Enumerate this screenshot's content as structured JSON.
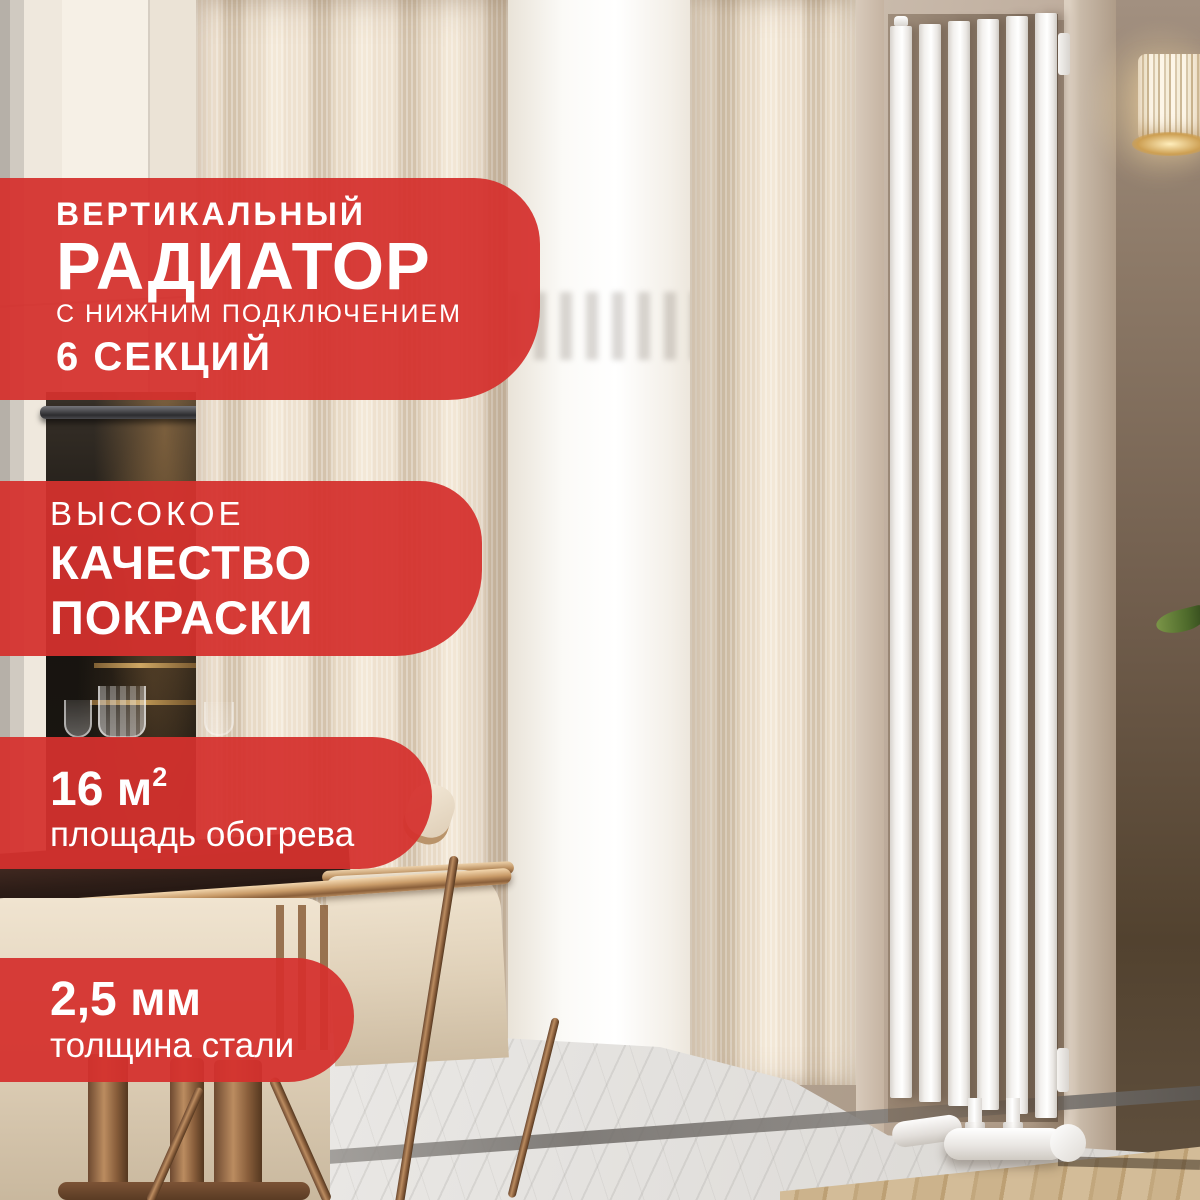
{
  "colors": {
    "badge_red": "#d5312e",
    "badge_text": "#ffffff",
    "radiator_white": "#f6f4f1",
    "wall_taupe": "#b3a292"
  },
  "badges": {
    "title": {
      "line1": "ВЕРТИКАЛЬНЫЙ",
      "line2": "РАДИАТОР",
      "line3": "С НИЖНИМ ПОДКЛЮЧЕНИЕМ",
      "line4": "6 СЕКЦИЙ"
    },
    "quality": {
      "line1": "ВЫСОКОЕ",
      "line2": "КАЧЕСТВО",
      "line3": "ПОКРАСКИ"
    },
    "area": {
      "value": "16 м",
      "sup": "2",
      "label": "площадь обогрева"
    },
    "steel": {
      "value": "2,5 мм",
      "label": "толщина стали"
    }
  }
}
